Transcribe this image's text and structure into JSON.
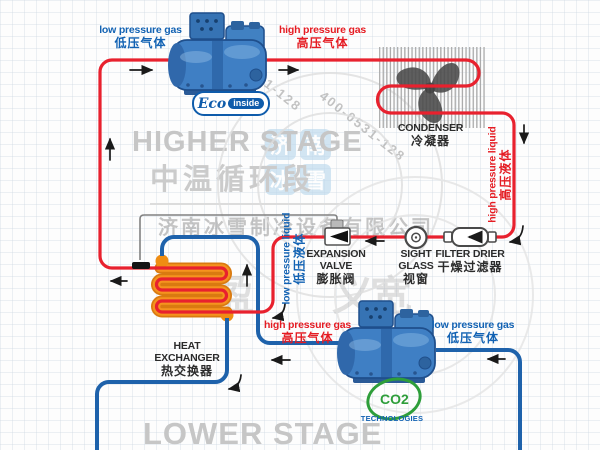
{
  "watermarks": {
    "higher_stage_en": "HIGHER STAGE",
    "higher_stage_zh": "中温循环段",
    "lower_stage_en": "LOWER STAGE",
    "company": "济南冰雪制冷设备有限公司",
    "phone": "400-0531-128",
    "big_char_1": "盈",
    "big_char_2": "义",
    "big_char_3": "宽",
    "logo_square_1": "济",
    "logo_square_2": "南",
    "logo_square_3": "冰",
    "logo_square_4": "雪"
  },
  "higher_stage": {
    "suction_label_en": "low pressure gas",
    "suction_label_zh": "低压气体",
    "discharge_label_en": "high pressure gas",
    "discharge_label_zh": "高压气体",
    "liquid_label_en": "high pressure liquid",
    "liquid_label_zh": "高压液体",
    "expansion_outlet_label_en": "low pressure liquid",
    "expansion_outlet_label_zh": "低压液体"
  },
  "lower_stage": {
    "discharge_label_en": "high pressure gas",
    "discharge_label_zh": "高压气体",
    "suction_label_en": "low pressure gas",
    "suction_label_zh": "低压气体"
  },
  "components": {
    "condenser_en": "CONDENSER",
    "condenser_zh": "冷凝器",
    "filter_drier_en": "FILTER DRIER",
    "filter_drier_zh": "干燥过滤器",
    "sight_glass_en": "SIGHT GLASS",
    "sight_glass_zh": "视窗",
    "expansion_valve_en": "EXPANSION VALVE",
    "expansion_valve_zh": "膨胀阀",
    "heat_exchanger_en": "HEAT EXCHANGER",
    "heat_exchanger_zh": "热交换器"
  },
  "logos": {
    "eco_script": "Eco",
    "eco_badge": "inside",
    "co2_text": "CO2",
    "co2_sub": "TECHNOLOGIES"
  },
  "colors": {
    "higher_pipe_red": "#e8212e",
    "lower_pipe_blue": "#1e62ab",
    "coil_orange": "#ef8d13",
    "label_red": "#e51c23",
    "label_blue": "#1262b3",
    "compressor_blue": "#3f7fc4",
    "logo_green": "#2e9e3a",
    "watermark_grey": "#c9c9c9"
  }
}
